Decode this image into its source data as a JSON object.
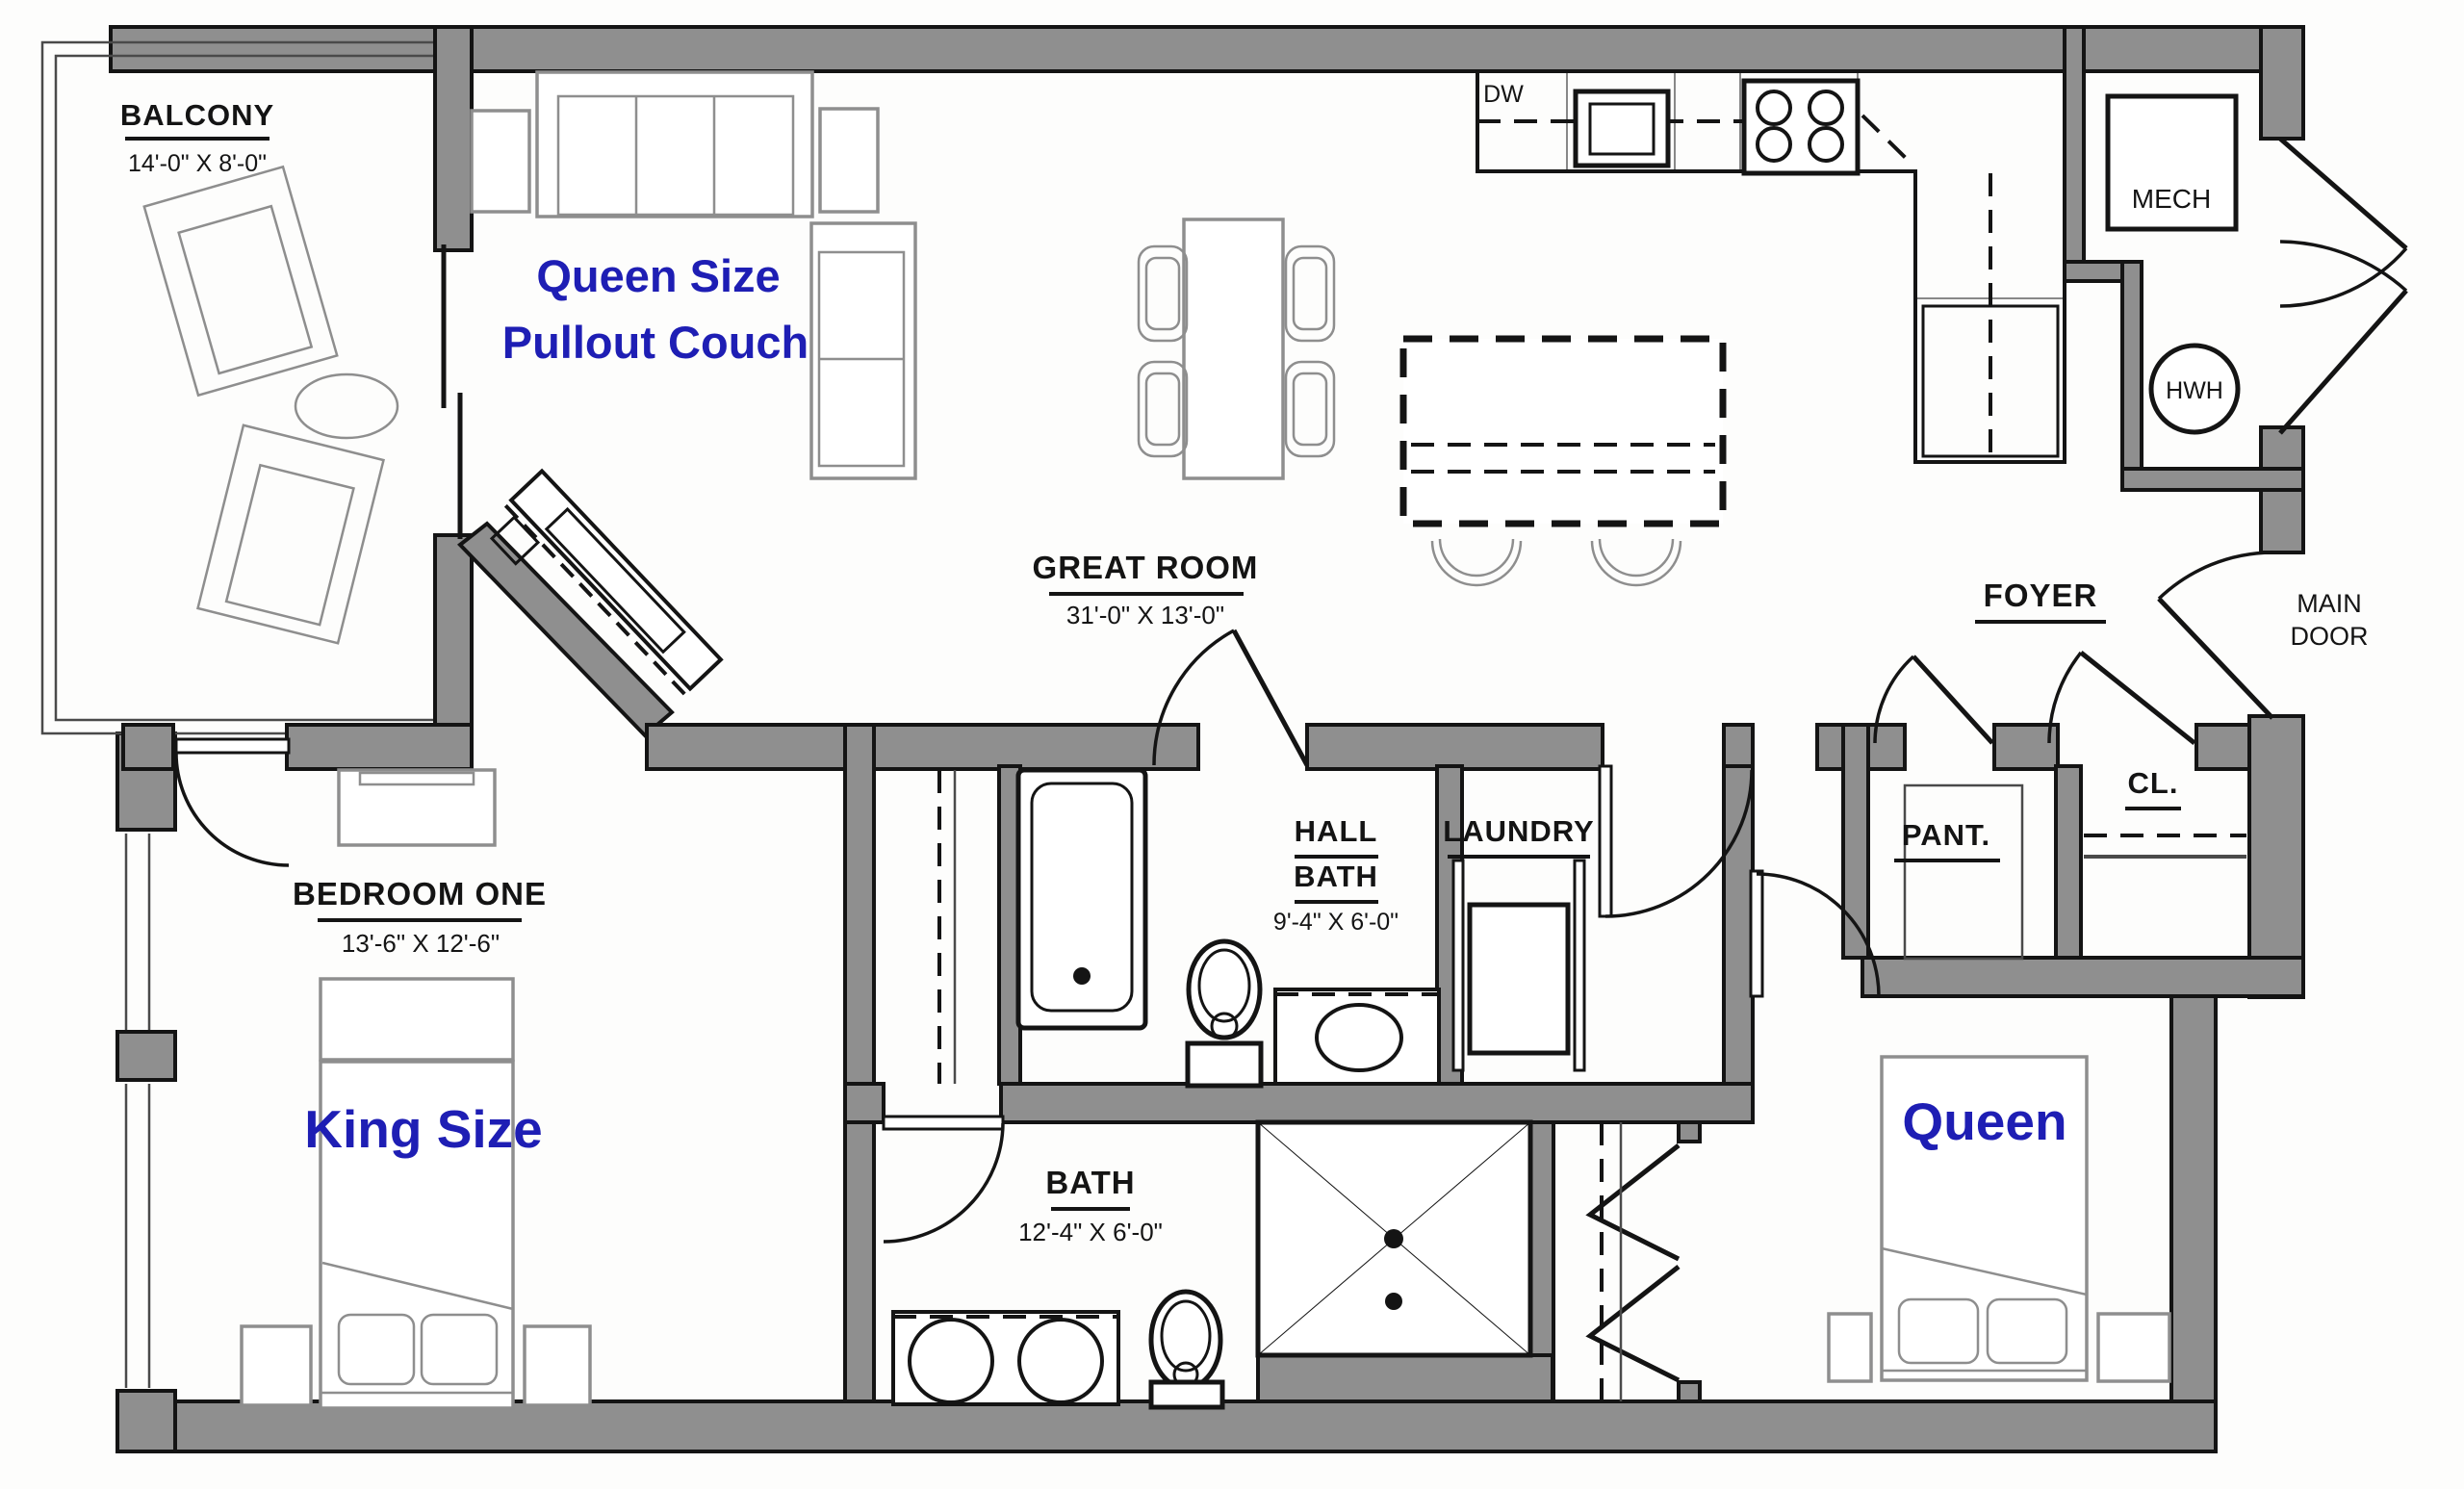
{
  "plan": {
    "balcony": {
      "label": "BALCONY",
      "dims": "14'-0\" X 8'-0\""
    },
    "great_room": {
      "label": "GREAT ROOM",
      "dims": "31'-0\" X 13'-0\"",
      "couch_line1": "Queen Size",
      "couch_line2": "Pullout Couch"
    },
    "kitchen": {
      "dishwasher": "DW"
    },
    "mech": {
      "label": "MECH",
      "water_heater": "HWH"
    },
    "foyer": {
      "label": "FOYER",
      "main_door_line1": "MAIN",
      "main_door_line2": "DOOR"
    },
    "pantry": {
      "label": "PANT."
    },
    "closet": {
      "label": "CL."
    },
    "hall_bath": {
      "label_line1": "HALL",
      "label_line2": "BATH",
      "dims": "9'-4\" X 6'-0\""
    },
    "laundry": {
      "label": "LAUNDRY"
    },
    "bedroom_one": {
      "label": "BEDROOM ONE",
      "dims": "13'-6\" X 12'-6\"",
      "bed_label": "King Size"
    },
    "bath": {
      "label": "BATH",
      "dims": "12'-4\" X 6'-0\""
    },
    "bedroom_two": {
      "bed_label": "Queen"
    }
  },
  "colors": {
    "wall_fill": "#8f8f8f",
    "line_black": "#141414",
    "furniture_gray": "#8e8e8e",
    "accent_blue": "#1e1eb4",
    "background": "#fdfdfc"
  }
}
